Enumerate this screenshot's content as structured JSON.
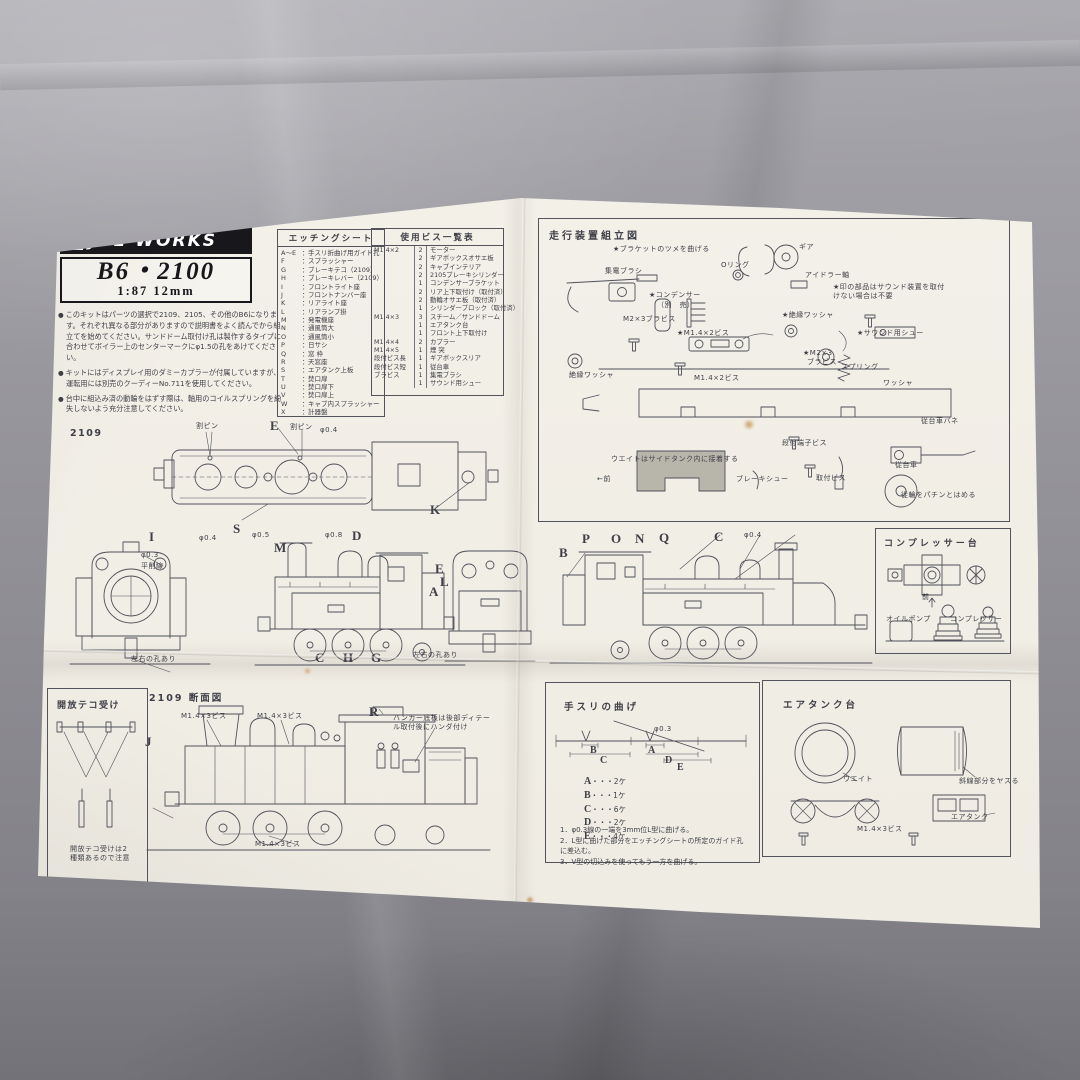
{
  "photo": {
    "fabric_color": "#8e8d93",
    "paper_color": "#f2efe7",
    "ink_color": "#45454d",
    "weight_fill": "#b8b5ab",
    "stain_color": "#c08030"
  },
  "header": {
    "brand": "JOE WORKS",
    "logo_icon": "window-grid-icon",
    "model": "B6・2100",
    "scale": "1:87 12mm",
    "notes": [
      "このキットはパーツの選択で2109、2105、その他のB6になります。それぞれ異なる部分がありますので説明書をよく読んでから組立てを始めてください。サンドドーム取付け孔は製作するタイプに合わせてボイラー上のセンターマークにφ1.5の孔をあけてください。",
      "キットにはディスプレイ用のダミーカプラーが付属していますが、運転用には別売のクーディーNo.711を使用してください。",
      "台中に組込み済の動輪をはずす際は、軸用のコイルスプリングを紛失しないよう充分注意してください。"
    ]
  },
  "etching": {
    "title": "エッチングシート",
    "items": [
      {
        "key": "A〜E",
        "label": "手スリ折曲げ用ガイド孔"
      },
      {
        "key": "F",
        "label": "スプラッシャー"
      },
      {
        "key": "G",
        "label": "ブレーキテコ（2109）"
      },
      {
        "key": "H",
        "label": "ブレーキレバー（2109）"
      },
      {
        "key": "I",
        "label": "フロントライト座"
      },
      {
        "key": "J",
        "label": "フロントナンバー座"
      },
      {
        "key": "K",
        "label": "リアライト座"
      },
      {
        "key": "L",
        "label": "リアランプ掛"
      },
      {
        "key": "M",
        "label": "発電機座"
      },
      {
        "key": "N",
        "label": "通風筒大"
      },
      {
        "key": "O",
        "label": "通風筒小"
      },
      {
        "key": "P",
        "label": "日サシ"
      },
      {
        "key": "Q",
        "label": "窓 枠"
      },
      {
        "key": "R",
        "label": "天窓座"
      },
      {
        "key": "S",
        "label": "エアタンク上板"
      },
      {
        "key": "T",
        "label": "焚口扉"
      },
      {
        "key": "U",
        "label": "焚口扉下"
      },
      {
        "key": "V",
        "label": "焚口扉上"
      },
      {
        "key": "W",
        "label": "キャブ内スプラッシャー"
      },
      {
        "key": "X",
        "label": "計器盤"
      }
    ]
  },
  "screws": {
    "title": "使用ビス一覧表",
    "rows": [
      {
        "size": "M1.4×2",
        "qty": "2",
        "part": "モーター"
      },
      {
        "size": "",
        "qty": "2",
        "part": "ギアボックスオサエ板"
      },
      {
        "size": "",
        "qty": "2",
        "part": "キャブインテリア"
      },
      {
        "size": "",
        "qty": "2",
        "part": "2105ブレーキシリンダー"
      },
      {
        "size": "",
        "qty": "1",
        "part": "コンデンサーブラケット"
      },
      {
        "size": "",
        "qty": "2",
        "part": "リア上下取付け（取付済）"
      },
      {
        "size": "",
        "qty": "2",
        "part": "動輪オサエ板（取付済）"
      },
      {
        "size": "",
        "qty": "1",
        "part": "シリンダーブロック（取付済）"
      },
      {
        "size": "M1.4×3",
        "qty": "3",
        "part": "スチーム／サンドドーム"
      },
      {
        "size": "",
        "qty": "1",
        "part": "エアタンク台"
      },
      {
        "size": "",
        "qty": "1",
        "part": "フロント上下取付け"
      },
      {
        "size": "M1.4×4",
        "qty": "2",
        "part": "カプラー"
      },
      {
        "size": "M1.4×5",
        "qty": "1",
        "part": "煙 突"
      },
      {
        "size": "段付ビス長",
        "qty": "1",
        "part": "ギアボックスリア"
      },
      {
        "size": "段付ビス短",
        "qty": "1",
        "part": "従台車"
      },
      {
        "size": "ブラビス",
        "qty": "1",
        "part": "集電ブラシ"
      },
      {
        "size": "",
        "qty": "1",
        "part": "サウンド用シュー"
      }
    ]
  },
  "assembly": {
    "title": "走行装置組立図",
    "labels": [
      {
        "t": "★ブラケットのツメを曲げる",
        "x": 74,
        "y": 26
      },
      {
        "t": "ギア",
        "x": 260,
        "y": 24
      },
      {
        "t": "Oリング",
        "x": 182,
        "y": 42
      },
      {
        "t": "アイドラー軸",
        "x": 266,
        "y": 52
      },
      {
        "t": "集電ブラシ",
        "x": 66,
        "y": 48
      },
      {
        "t": "★印の部品はサウンド装置を取付けない場合は不要",
        "x": 294,
        "y": 64,
        "w": 116
      },
      {
        "t": "★コンデンサー",
        "x": 110,
        "y": 72
      },
      {
        "t": "（別　売）",
        "x": 118,
        "y": 82
      },
      {
        "t": "M2×3ブラビス",
        "x": 84,
        "y": 96
      },
      {
        "t": "★絶縁ワッシャ",
        "x": 243,
        "y": 92
      },
      {
        "t": "★M1.4×2ビス",
        "x": 138,
        "y": 110
      },
      {
        "t": "★サウンド用シュー",
        "x": 318,
        "y": 110
      },
      {
        "t": "★M2×3",
        "x": 264,
        "y": 130
      },
      {
        "t": "ブラビス",
        "x": 268,
        "y": 139
      },
      {
        "t": "スプリング",
        "x": 302,
        "y": 144
      },
      {
        "t": "絶縁ワッシャ",
        "x": 30,
        "y": 152
      },
      {
        "t": "M1.4×2ビス",
        "x": 155,
        "y": 155
      },
      {
        "t": "ワッシャ",
        "x": 344,
        "y": 160
      },
      {
        "t": "従台車バネ",
        "x": 382,
        "y": 198
      },
      {
        "t": "段付端子ビス",
        "x": 243,
        "y": 220
      },
      {
        "t": "ウエイトはサイドタンク内に接着する",
        "x": 72,
        "y": 236
      },
      {
        "t": "←前",
        "x": 58,
        "y": 256
      },
      {
        "t": "ブレーキシュー",
        "x": 197,
        "y": 256
      },
      {
        "t": "取付ビス",
        "x": 277,
        "y": 255
      },
      {
        "t": "従台車",
        "x": 356,
        "y": 242
      },
      {
        "t": "従輪をパチンとはめる",
        "x": 362,
        "y": 272
      }
    ]
  },
  "compressor": {
    "title": "コンプレッサー台",
    "labels": [
      {
        "t": "前",
        "x": 46,
        "y": 64
      },
      {
        "t": "オイルポンプ",
        "x": 10,
        "y": 86
      },
      {
        "t": "コンプレッサー",
        "x": 74,
        "y": 86
      }
    ]
  },
  "drawings": {
    "variant": "2109",
    "top_view_labels": [
      {
        "t": "割ピン",
        "x": 46,
        "y": 4
      },
      {
        "t": "E",
        "x": 120,
        "y": 0,
        "c": "letter"
      },
      {
        "t": "割ピン",
        "x": 140,
        "y": 5
      },
      {
        "t": "φ0.4",
        "x": 170,
        "y": 8
      },
      {
        "t": "S",
        "x": 83,
        "y": 103,
        "c": "letter"
      },
      {
        "t": "K",
        "x": 280,
        "y": 84,
        "c": "letter"
      }
    ],
    "row2_labels": [
      {
        "t": "φ0.3",
        "x": 86,
        "y": 28
      },
      {
        "t": "平削線",
        "x": 86,
        "y": 39
      },
      {
        "t": "左右の孔あり",
        "x": 76,
        "y": 132
      },
      {
        "t": "I",
        "x": 94,
        "y": 6,
        "c": "letter"
      },
      {
        "t": "φ0.4",
        "x": 144,
        "y": 11
      },
      {
        "t": "φ0.5",
        "x": 197,
        "y": 8
      },
      {
        "t": "M",
        "x": 219,
        "y": 17,
        "c": "letter"
      },
      {
        "t": "φ0.8",
        "x": 270,
        "y": 8
      },
      {
        "t": "D",
        "x": 297,
        "y": 5,
        "c": "letter"
      },
      {
        "t": "C",
        "x": 260,
        "y": 127,
        "c": "letter"
      },
      {
        "t": "H",
        "x": 288,
        "y": 127,
        "c": "letter"
      },
      {
        "t": "G",
        "x": 316,
        "y": 127,
        "c": "letter"
      },
      {
        "t": "左右の孔あり",
        "x": 358,
        "y": 128
      },
      {
        "t": "E",
        "x": 380,
        "y": 38,
        "c": "letter"
      },
      {
        "t": "L",
        "x": 385,
        "y": 51,
        "c": "letter"
      },
      {
        "t": "A",
        "x": 374,
        "y": 61,
        "c": "letter"
      }
    ],
    "row3_labels": [
      {
        "t": "B",
        "x": 14,
        "y": 22,
        "c": "letter"
      },
      {
        "t": "P",
        "x": 37,
        "y": 8,
        "c": "letter"
      },
      {
        "t": "O",
        "x": 66,
        "y": 8,
        "c": "letter"
      },
      {
        "t": "N",
        "x": 90,
        "y": 8,
        "c": "letter"
      },
      {
        "t": "Q",
        "x": 114,
        "y": 7,
        "c": "letter"
      },
      {
        "t": "C",
        "x": 169,
        "y": 6,
        "c": "letter"
      },
      {
        "t": "φ0.4",
        "x": 199,
        "y": 8
      }
    ]
  },
  "lever": {
    "title": "開放テコ受け",
    "note": "開放テコ受けは2種類あるので注意"
  },
  "section": {
    "title": "2109 断面図",
    "labels": [
      {
        "t": "J",
        "x": 0,
        "y": 46,
        "c": "letter"
      },
      {
        "t": "M1.4×3ビス",
        "x": 36,
        "y": 24
      },
      {
        "t": "M1.4×3ビス",
        "x": 112,
        "y": 24
      },
      {
        "t": "R",
        "x": 224,
        "y": 16,
        "c": "letter"
      },
      {
        "t": "バンカー底板は後部ディテール取付後にハンダ付け",
        "x": 248,
        "y": 26,
        "w": 104
      },
      {
        "t": "M1.4×3ビス",
        "x": 110,
        "y": 152
      }
    ]
  },
  "handrail": {
    "title": "手スリの曲げ",
    "separator": "・・・",
    "diagram_labels": [
      {
        "t": "φ0.3",
        "x": 108,
        "y": 42
      },
      {
        "t": "B",
        "x": 44,
        "y": 62,
        "c": "letter-sm"
      },
      {
        "t": "C",
        "x": 54,
        "y": 72,
        "c": "letter-sm"
      },
      {
        "t": "A",
        "x": 102,
        "y": 62,
        "c": "letter-sm"
      },
      {
        "t": "D",
        "x": 119,
        "y": 72,
        "c": "letter-sm"
      },
      {
        "t": "E",
        "x": 131,
        "y": 79,
        "c": "letter-sm"
      }
    ],
    "counts": [
      {
        "key": "A",
        "value": "2ケ"
      },
      {
        "key": "B",
        "value": "1ケ"
      },
      {
        "key": "C",
        "value": "6ケ"
      },
      {
        "key": "D",
        "value": "2ケ"
      },
      {
        "key": "E",
        "value": "4ケ"
      }
    ],
    "steps": [
      "1．φ0.3線の一端を3mm位L型に曲げる。",
      "2．L型に曲げた部分をエッチングシートの所定のガイド孔に差込む。",
      "3．V型の切込みを使ってもう一方を曲げる。"
    ]
  },
  "airtank": {
    "title": "エアタンク台",
    "labels": [
      {
        "t": "ウエイト",
        "x": 80,
        "y": 94
      },
      {
        "t": "斜線部分をヤスる",
        "x": 196,
        "y": 96
      },
      {
        "t": "エアタンク",
        "x": 188,
        "y": 132
      },
      {
        "t": "M1.4×3ビス",
        "x": 94,
        "y": 144
      }
    ]
  }
}
